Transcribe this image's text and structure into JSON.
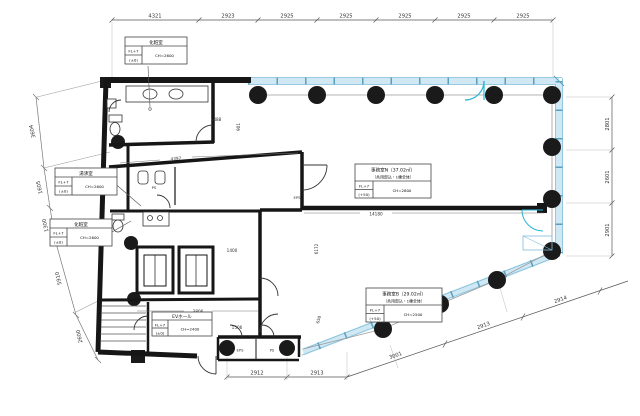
{
  "drawing": {
    "room_boxes": {
      "powder_top": {
        "title": "化粧室",
        "fl": "FL+7",
        "fl_sub": "(±0)",
        "ch": "CH=2600"
      },
      "kitchenette": {
        "title": "湯沸室",
        "fl": "FL+7",
        "fl_sub": "(±0)",
        "ch": "CH=2600"
      },
      "powder_left": {
        "title": "化粧室",
        "fl": "FL+7",
        "fl_sub": "(±0)",
        "ch": "CH=2600"
      },
      "office_n": {
        "title": "事務室N（37.02㎡）",
        "subtitle": "（共用部込・1棟全体）",
        "fl": "FL+7",
        "fl_sub": "(+50)",
        "ch": "CH=2800"
      },
      "office_b": {
        "title": "事務室B（29.02㎡）",
        "subtitle": "（共用部込・1棟全体）",
        "fl": "FL+7",
        "fl_sub": "(+50)",
        "ch": "CH=2500"
      },
      "ev_hall": {
        "title": "EVホール",
        "fl": "FL+7",
        "fl_sub": "(±0)",
        "ch": "CH=2400"
      }
    },
    "dims": {
      "top": [
        "4321",
        "2923",
        "2925",
        "2925",
        "2925",
        "2925",
        "2925"
      ],
      "right": [
        "2801",
        "2601",
        "2901"
      ],
      "left": [
        "3604",
        "1605",
        "1300",
        "5910",
        "2600"
      ],
      "bottom": [
        "2912",
        "2913"
      ],
      "diagonal": [
        "3001",
        "2913",
        "2914"
      ],
      "interior": {
        "partition": "14180",
        "core_diag": "4397",
        "elevators": "3806",
        "w1400": "1400",
        "w1506": "1506",
        "w901": "901",
        "w1488": "1488",
        "w6172": "6172",
        "w650": "650",
        "w1098": "1098"
      }
    },
    "small_labels": {
      "eps_core": "EPS",
      "ps_core": "PS",
      "eps_strip": "EPS",
      "ps_strip": "PS"
    },
    "colors": {
      "wall": "#161616",
      "glazing_fill": "#cfe8f4",
      "glazing_stroke": "#7fbdd8",
      "door_accent": "#29b6d8",
      "dim_line": "#555555"
    }
  }
}
